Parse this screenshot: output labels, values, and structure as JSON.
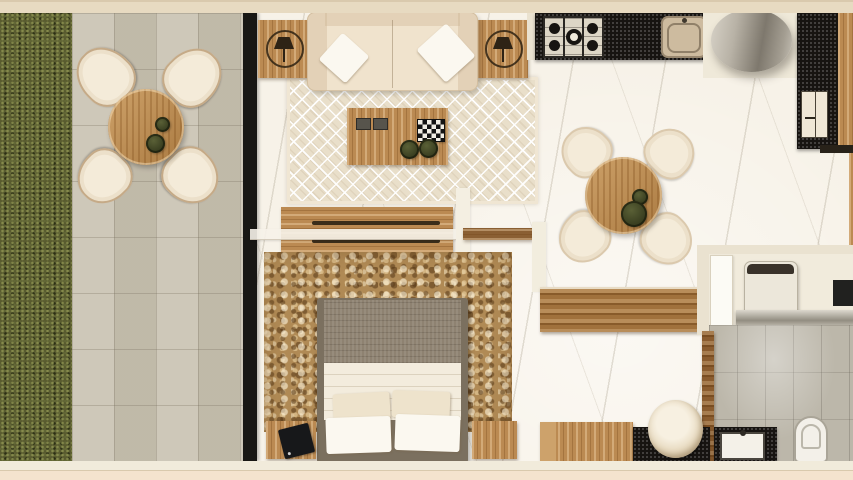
{
  "palette": {
    "outerBand": "#e7dac1",
    "outerBand2": "#f4e3ce",
    "outerEdge": "#d9c9ad",
    "wallCream": "#eae2d0",
    "grass": "#595b2f",
    "patio": "#c9c2b1",
    "wallBlack": "#181714",
    "marble": "#f7f2e8",
    "tileGrey": "#bcb7aa",
    "woodMid": "#bb8a52",
    "woodDark": "#a0713c",
    "counterBlack": "#171411",
    "stainless": "#ddd6c6",
    "sinkTan": "#cdbb9f",
    "chairCream": "#ece0ca",
    "chairInner": "#f4ebd9",
    "rugLiving": "#e9dfca",
    "rugBed": "#b08a55",
    "sofa": "#f0e3cd",
    "pillow": "#fbf8f0",
    "bedFrame": "#7b705f",
    "bedBlanket": "#8e8271",
    "bedSheet": "#f3ecdd",
    "toilet": "#f3f0e9",
    "washer": "#ece7da",
    "washerPanel": "#39322a",
    "door": "#fcfbf5",
    "tablet": "#17181a",
    "oliveDark": "#4b5029",
    "olive": "#5a6036"
  },
  "plan": {
    "type": "apartment-floor-plan",
    "labels": {
      "plan": "Apartment floor plan (top view render)",
      "garden": "Garden grass strip",
      "terrace": "Terrace with outdoor dining set",
      "terrace_table": "Round outdoor table",
      "terrace_chair": "Outdoor chair",
      "living_room": "Living room",
      "sofa": "Two-seat sofa with cushions",
      "side_table": "Wooden side table",
      "table_lamp": "Table lamp (plan symbol)",
      "living_rug": "Diamond-pattern area rug",
      "coffee_table": "Wooden coffee table",
      "tray": "Checkered tray",
      "bowl": "Decorative bowl",
      "tv_console": "Wooden TV console",
      "wall_shelf": "Wall shelf",
      "bedroom": "Bedroom",
      "bedroom_rug": "Vintage bedroom rug",
      "bed": "Double bed with pillows",
      "nightstand": "Wooden nightstand",
      "tablet": "Tablet on nightstand",
      "credenza": "Wooden credenza",
      "dining_area": "Dining area",
      "dining_table": "Round dining table",
      "dining_chair": "Dining chair",
      "kitchen": "Kitchen",
      "cooktop": "Five-burner gas cooktop",
      "kitchen_sink": "Kitchen sink",
      "column": "Cylindrical column",
      "wardrobe": "Wardrobe / closet unit",
      "bathroom": "Bathroom",
      "door": "Door leaf",
      "washing_machine": "Washing machine",
      "towel_bar": "Counter / towel bar",
      "mirror": "Wall mirror",
      "toilet": "Toilet",
      "bathroom_sink": "Bathroom sink on stone counter",
      "vanity": "Wooden vanity cabinet",
      "vessel_sink": "Round vessel basin",
      "walls": "Wall"
    }
  }
}
